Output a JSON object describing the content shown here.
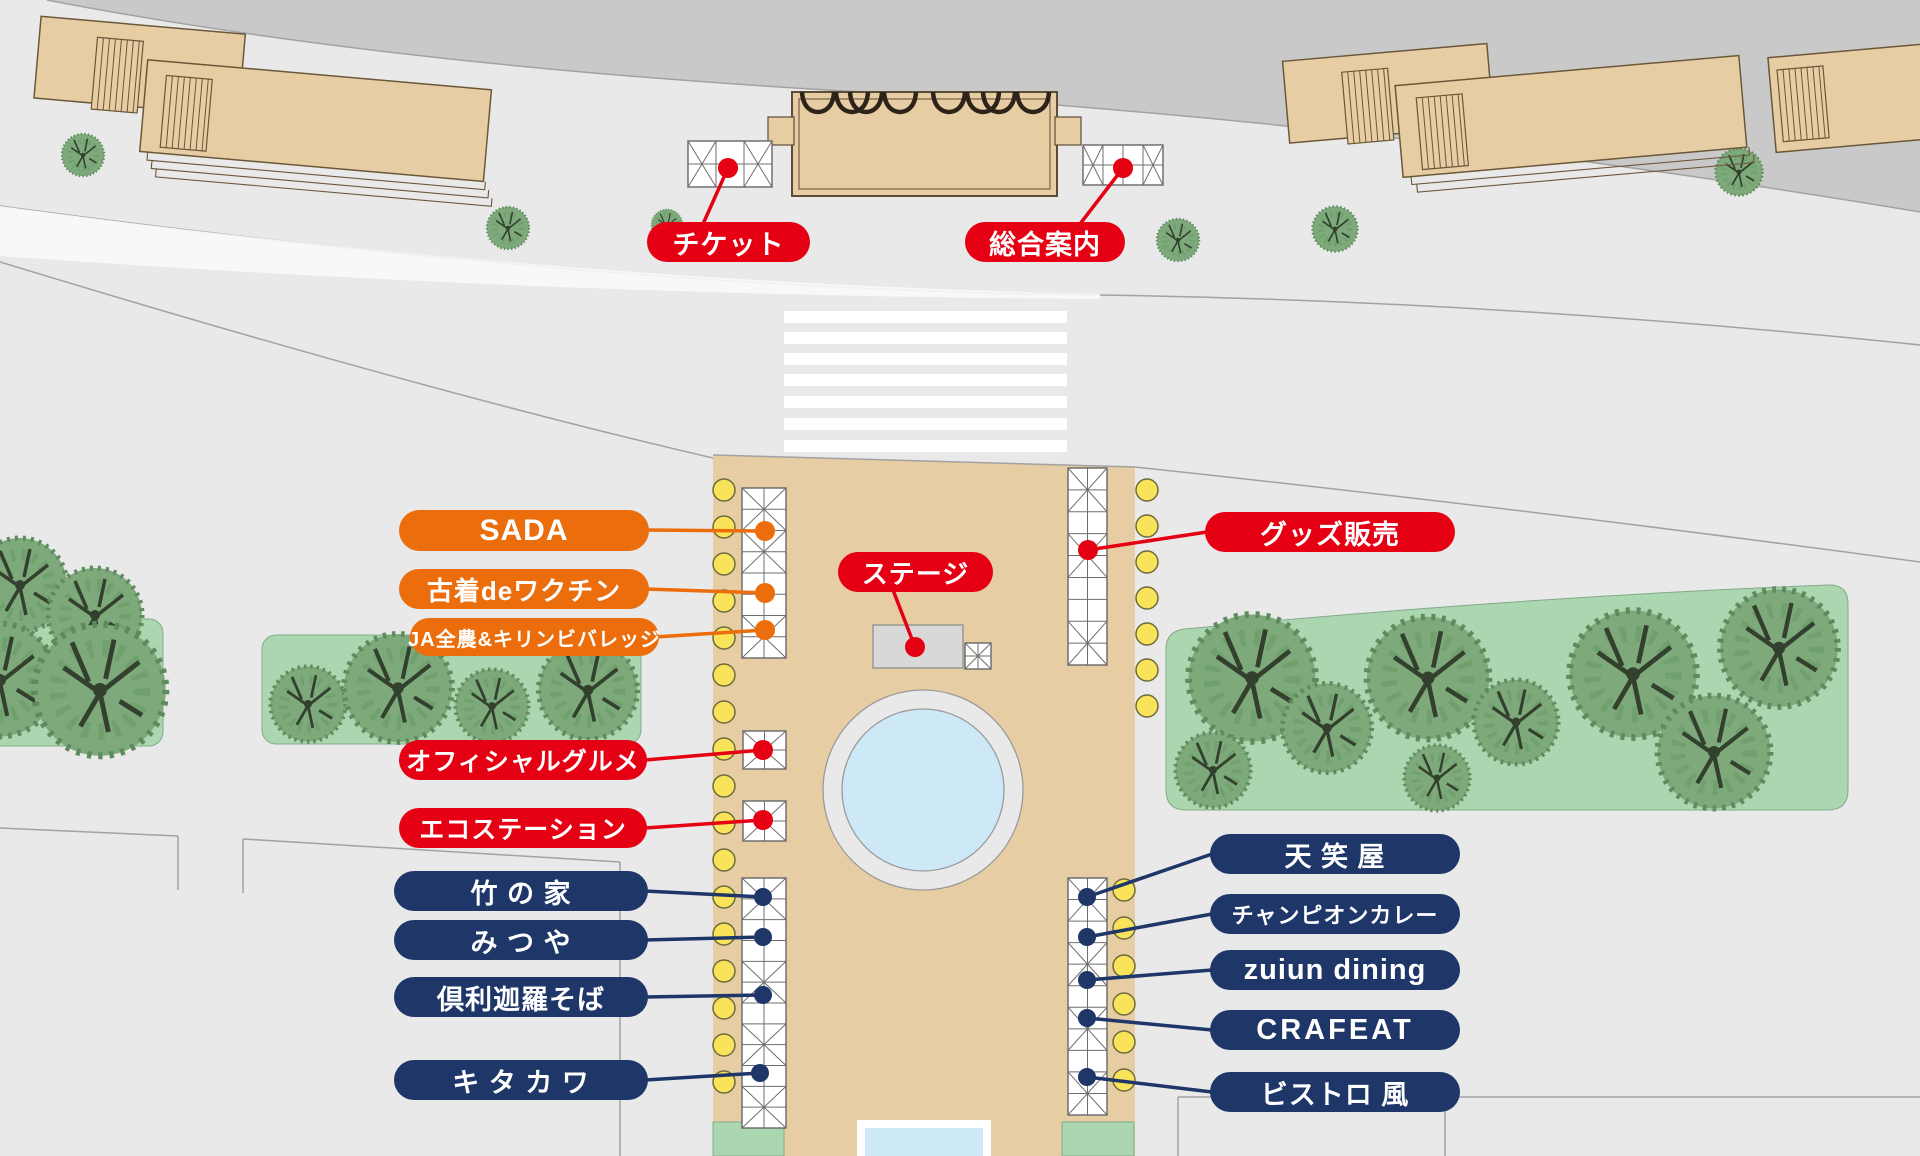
{
  "map": {
    "colors": {
      "red": "#e50013",
      "orange": "#eb6d0b",
      "navy": "#1e3668",
      "tan": "#e6cda3",
      "green": "#aad7af",
      "yellow_dot": "#f8e35b",
      "water": "#cde9f8",
      "band": "#c9c9ca",
      "bg": "#e9e9ea"
    },
    "labels": [
      {
        "id": "ticket",
        "text": "チケット",
        "category": "red"
      },
      {
        "id": "info",
        "text": "総合案内",
        "category": "red"
      },
      {
        "id": "sada",
        "text": "SADA",
        "category": "orange"
      },
      {
        "id": "furugi",
        "text": "古着deワクチン",
        "category": "orange"
      },
      {
        "id": "ja",
        "text": "JA全農&キリンビバレッジ",
        "category": "orange"
      },
      {
        "id": "stage",
        "text": "ステージ",
        "category": "red"
      },
      {
        "id": "goods",
        "text": "グッズ販売",
        "category": "red"
      },
      {
        "id": "gourmet",
        "text": "オフィシャルグルメ",
        "category": "red"
      },
      {
        "id": "eco",
        "text": "エコステーション",
        "category": "red"
      },
      {
        "id": "takenoya",
        "text": "竹 の 家",
        "category": "navy"
      },
      {
        "id": "mitsuya",
        "text": "み つ や",
        "category": "navy"
      },
      {
        "id": "kurikara",
        "text": "倶利迦羅そば",
        "category": "navy"
      },
      {
        "id": "kitakawa",
        "text": "キ タ カ ワ",
        "category": "navy"
      },
      {
        "id": "tenshoya",
        "text": "天 笑 屋",
        "category": "navy"
      },
      {
        "id": "champion",
        "text": "チャンピオンカレー",
        "category": "navy"
      },
      {
        "id": "zuiun",
        "text": "zuiun dining",
        "category": "navy"
      },
      {
        "id": "crafeat",
        "text": "CRAFEAT",
        "category": "navy"
      },
      {
        "id": "bistro",
        "text": "ビストロ 風",
        "category": "navy"
      }
    ]
  }
}
